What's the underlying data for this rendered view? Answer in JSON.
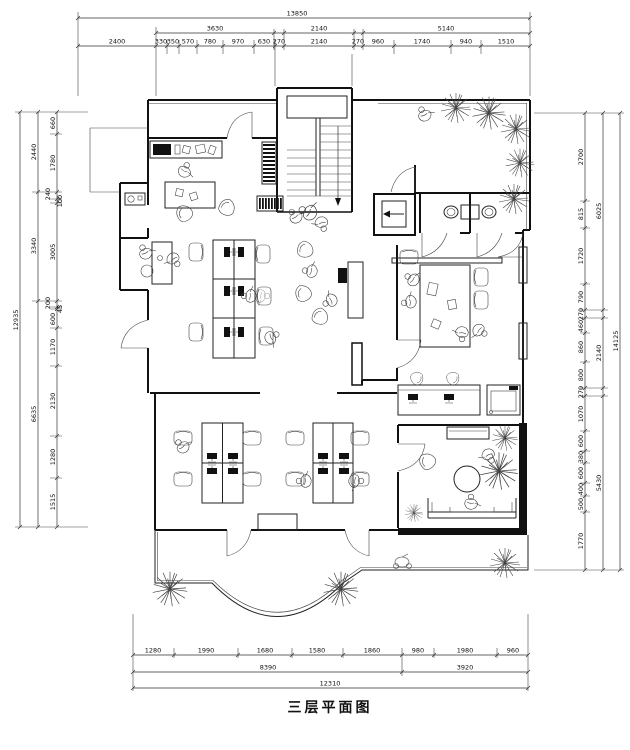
{
  "title": "三层平面图",
  "dimensions": {
    "top": {
      "total": "13850",
      "row2": [
        "3630",
        "2140",
        "5140"
      ],
      "row3": [
        "2400",
        "330",
        "350",
        "570",
        "780",
        "970",
        "630",
        "270",
        "2140",
        "270",
        "960",
        "1740",
        "940",
        "1510"
      ]
    },
    "left": {
      "outer": "12935",
      "middle": [
        "2440",
        "3340",
        "6635"
      ],
      "inner": [
        "660",
        "1780",
        "240",
        "100",
        "3005",
        "200",
        "45",
        "600",
        "1170",
        "2130",
        "1280",
        "1515"
      ]
    },
    "right": {
      "outer": "14125",
      "middle": [
        "6025",
        "2140",
        "5430"
      ],
      "inner": [
        "2700",
        "815",
        "1720",
        "790",
        "270",
        "460",
        "860",
        "800",
        "270",
        "1070",
        "600",
        "380",
        "600",
        "400",
        "500",
        "1770"
      ]
    },
    "bottom": {
      "row1": [
        "1280",
        "1990",
        "1680",
        "1580",
        "1860",
        "980",
        "1980",
        "960"
      ],
      "row2": [
        "8390",
        "3920"
      ],
      "total": "12310"
    }
  }
}
